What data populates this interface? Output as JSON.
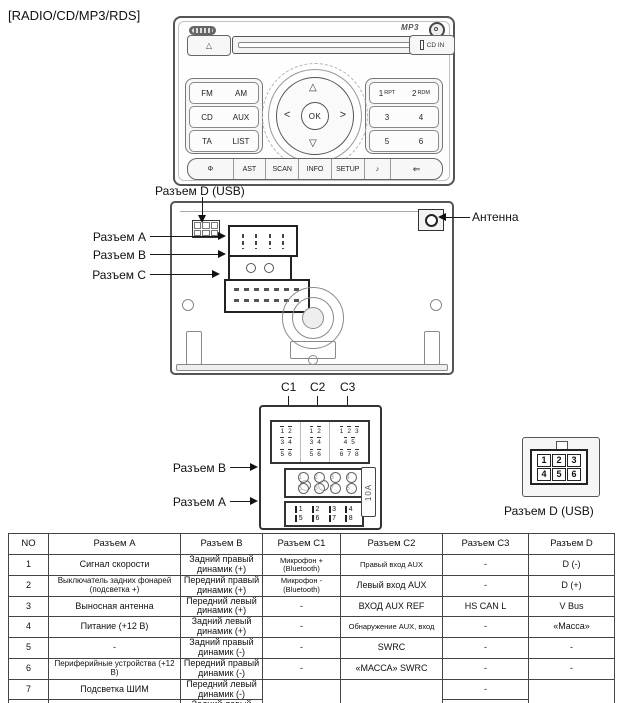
{
  "title": "[RADIO/CD/MP3/RDS]",
  "faceplate": {
    "mp3_logo": "MP3",
    "cd_in_label": "CD IN",
    "eject_symbol": "△",
    "left_buttons": [
      [
        "FM",
        "AM"
      ],
      [
        "CD",
        "AUX"
      ],
      [
        "TA",
        "LIST"
      ]
    ],
    "right_buttons": [
      [
        {
          "n": "1",
          "s": "RPT"
        },
        {
          "n": "2",
          "s": "RDM"
        }
      ],
      [
        {
          "n": "3",
          "s": ""
        },
        {
          "n": "4",
          "s": ""
        }
      ],
      [
        {
          "n": "5",
          "s": ""
        },
        {
          "n": "6",
          "s": ""
        }
      ]
    ],
    "dpad": {
      "up": "△",
      "down": "▽",
      "left": "<",
      "right": ">",
      "center": "OK"
    },
    "bottom_buttons": [
      "Φ",
      "AST",
      "SCAN",
      "INFO",
      "SETUP",
      "♪",
      "⇐"
    ]
  },
  "rear_labels": {
    "d_usb": "Разъем D (USB)",
    "a": "Разъем A",
    "b": "Разъем B",
    "c": "Разъем C",
    "antenna": "Антенна"
  },
  "pinout": {
    "c_labels": [
      "C1",
      "C2",
      "C3"
    ],
    "c1_pins": [
      [
        "1",
        "2"
      ],
      [
        "3",
        "4"
      ],
      [
        "5",
        "6"
      ]
    ],
    "c2_pins": [
      [
        "1",
        "2"
      ],
      [
        "3",
        "4"
      ],
      [
        "5",
        "6"
      ]
    ],
    "c3_pins": [
      [
        "1",
        "2",
        "3"
      ],
      [
        "4",
        "5"
      ],
      [
        "6",
        "7",
        "8"
      ]
    ],
    "b_label": "Разъем B",
    "a_label": "Разъем A",
    "ba_pins": [
      [
        "1",
        "2",
        "3",
        "4"
      ],
      [
        "5",
        "6",
        "7",
        "8"
      ]
    ],
    "fuse_label": "10A",
    "d_pins": [
      [
        "1",
        "2",
        "3"
      ],
      [
        "4",
        "5",
        "6"
      ]
    ],
    "d_label": "Разъем D (USB)"
  },
  "table": {
    "headers": [
      "NO",
      "Разъем A",
      "Разъем B",
      "Разъем C1",
      "Разъем C2",
      "Разъем C3",
      "Разъем D"
    ],
    "rows": [
      [
        "1",
        "Сигнал скорости",
        "Задний правый динамик (+)",
        "Микрофон + (Bluetooth)",
        "Правый вход AUX",
        "-",
        "D (-)"
      ],
      [
        "2",
        "Выключатель задних фонарей (подсветка +)",
        "Передний правый динамик (+)",
        "Микрофон - (Bluetooth)",
        "Левый вход AUX",
        "-",
        "D (+)"
      ],
      [
        "3",
        "Выносная антенна",
        "Передний левый динамик (+)",
        "-",
        "ВХОД AUX REF",
        "HS CAN L",
        "V Bus"
      ],
      [
        "4",
        "Питание (+12 В)",
        "Задний левый динамик (+)",
        "-",
        "Обнаружение AUX, вход",
        "-",
        "«Масса»"
      ],
      [
        "5",
        "-",
        "Задний правый динамик (-)",
        "-",
        "SWRC",
        "-",
        "-"
      ],
      [
        "6",
        "Периферийные устройства (+12 В)",
        "Передний правый динамик (-)",
        "-",
        "«МАССА» SWRC",
        "-",
        "-"
      ],
      [
        "7",
        "Подсветка ШИМ",
        "Передний левый динамик (-)",
        {
          "text": "",
          "rowspan": 2
        },
        {
          "text": "",
          "rowspan": 2
        },
        "-",
        {
          "text": "",
          "rowspan": 2
        }
      ],
      [
        "8",
        "«Масса»",
        "Задний левый динамик (-)",
        null,
        null,
        "HS CAN H",
        null
      ]
    ]
  }
}
